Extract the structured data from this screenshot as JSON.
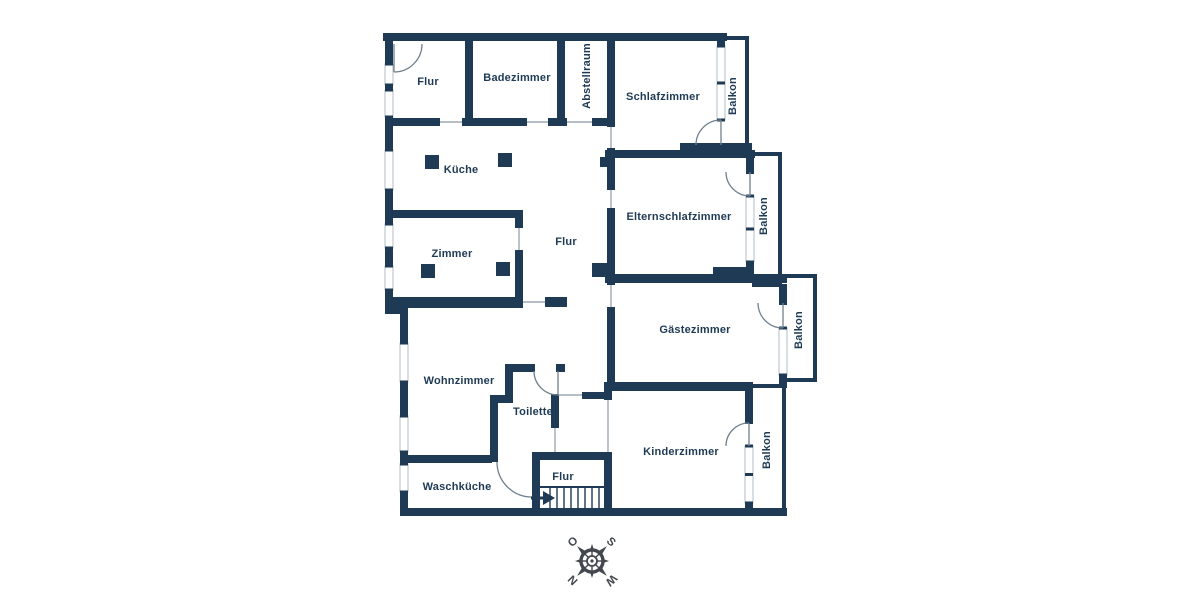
{
  "plan": {
    "type": "apartment-floorplan",
    "wall_color": "#1e3a55",
    "line_color": "#8b99a7",
    "background": "#ffffff",
    "room_labels": [
      {
        "id": "flur-oben",
        "text": "Flur",
        "x": 428,
        "y": 82,
        "rot": 0
      },
      {
        "id": "badezimmer",
        "text": "Badezimmer",
        "x": 517,
        "y": 78,
        "rot": 0
      },
      {
        "id": "abstellraum",
        "text": "Abstellraum",
        "x": 587,
        "y": 76,
        "rot": -90
      },
      {
        "id": "schlafzimmer",
        "text": "Schlafzimmer",
        "x": 663,
        "y": 97,
        "rot": 0
      },
      {
        "id": "balkon-schlafzimmer",
        "text": "Balkon",
        "x": 733,
        "y": 96,
        "rot": -90
      },
      {
        "id": "kueche",
        "text": "Küche",
        "x": 461,
        "y": 170,
        "rot": 0
      },
      {
        "id": "elternschlafzimmer",
        "text": "Elternschlafzimmer",
        "x": 679,
        "y": 217,
        "rot": 0
      },
      {
        "id": "balkon-eltern",
        "text": "Balkon",
        "x": 764,
        "y": 216,
        "rot": -90
      },
      {
        "id": "zimmer",
        "text": "Zimmer",
        "x": 452,
        "y": 254,
        "rot": 0
      },
      {
        "id": "flur-mitte",
        "text": "Flur",
        "x": 566,
        "y": 242,
        "rot": 0
      },
      {
        "id": "gaestezimmer",
        "text": "Gästezimmer",
        "x": 695,
        "y": 330,
        "rot": 0
      },
      {
        "id": "balkon-gaeste",
        "text": "Balkon",
        "x": 799,
        "y": 330,
        "rot": -90
      },
      {
        "id": "wohnzimmer",
        "text": "Wohnzimmer",
        "x": 459,
        "y": 381,
        "rot": 0
      },
      {
        "id": "toilette",
        "text": "Toilette",
        "x": 533,
        "y": 412,
        "rot": 0
      },
      {
        "id": "kinderzimmer",
        "text": "Kinderzimmer",
        "x": 681,
        "y": 452,
        "rot": 0
      },
      {
        "id": "balkon-kinder",
        "text": "Balkon",
        "x": 767,
        "y": 450,
        "rot": -90
      },
      {
        "id": "waschkueche",
        "text": "Waschküche",
        "x": 457,
        "y": 487,
        "rot": 0
      },
      {
        "id": "flur-unten",
        "text": "Flur",
        "x": 563,
        "y": 477,
        "rot": 0
      }
    ],
    "stairs": {
      "steps": 8,
      "direction_arrow": "right"
    },
    "compass": {
      "rotation_deg": 225,
      "color": "#43474e",
      "letters": [
        {
          "text": "N",
          "angle": 0
        },
        {
          "text": "O",
          "angle": 90
        },
        {
          "text": "S",
          "angle": 180
        },
        {
          "text": "W",
          "angle": 270
        }
      ]
    }
  }
}
